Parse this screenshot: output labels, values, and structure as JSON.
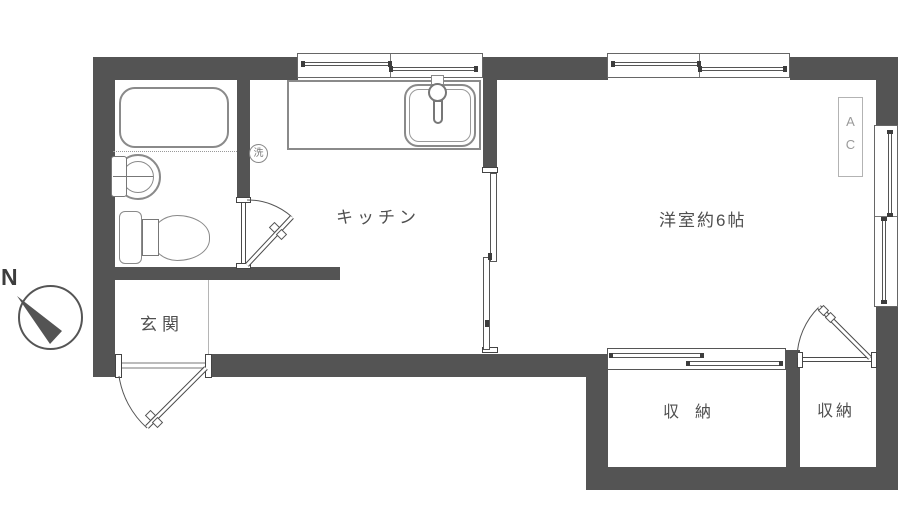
{
  "title": "apartment-floor-plan",
  "rooms": {
    "kitchen": {
      "label": "キッチン"
    },
    "western_room": {
      "label": "洋室約6帖"
    },
    "entrance": {
      "label": "玄関"
    },
    "storage_left": {
      "label": "収　納"
    },
    "storage_right": {
      "label": "収納"
    }
  },
  "fixtures": {
    "washer_symbol": "洗",
    "air_conditioner": {
      "line1": "A",
      "line2": "C"
    }
  },
  "compass": {
    "north_label": "N"
  },
  "colors": {
    "wall": "#545454",
    "fixture_line": "#8a8a8a",
    "text": "#4f4f4f",
    "ac_text": "#9a9a9a"
  }
}
